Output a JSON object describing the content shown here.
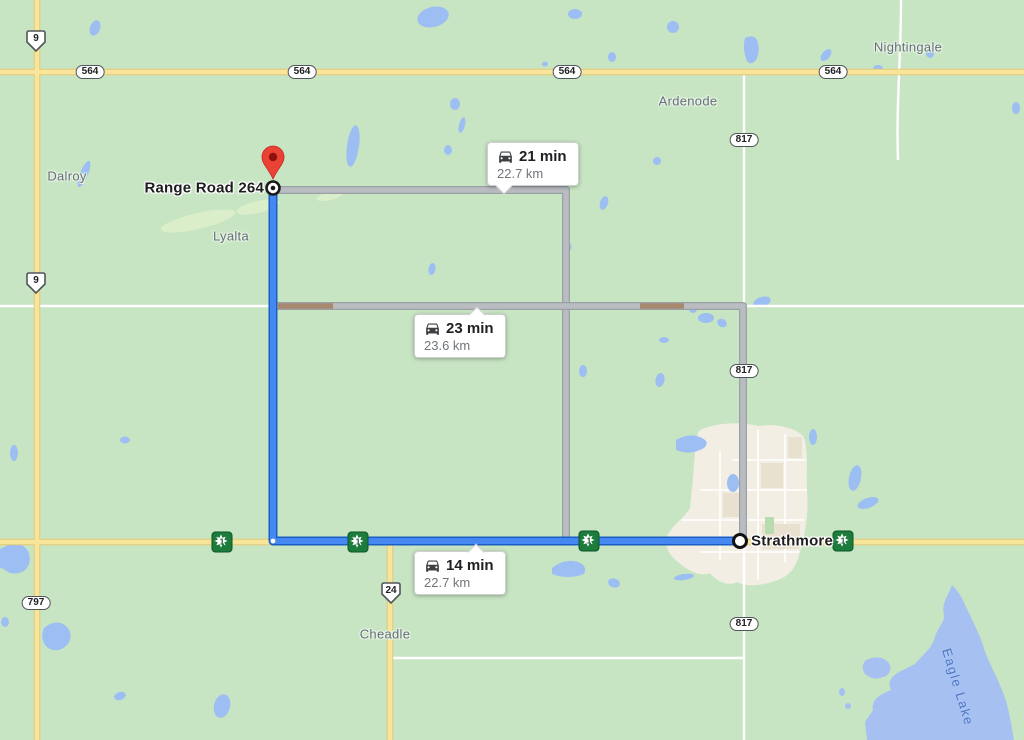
{
  "map_title": "Driving directions from Strathmore to Range Road 264",
  "places": {
    "nightingale": "Nightingale",
    "ardenode": "Ardenode",
    "dalroy": "Dalroy",
    "lyalta": "Lyalta",
    "cheadle": "Cheadle",
    "eagle_lake": "Eagle Lake"
  },
  "markers": {
    "destination_label": "Range Road 264",
    "origin_label": "Strathmore"
  },
  "routes": {
    "alt_north": {
      "duration": "21 min",
      "distance": "22.7 km",
      "selected": false
    },
    "alt_middle": {
      "duration": "23 min",
      "distance": "23.6 km",
      "selected": false
    },
    "main_south": {
      "duration": "14 min",
      "distance": "22.7 km",
      "selected": true
    }
  },
  "shields": {
    "hwy9": "9",
    "hwy24": "24",
    "hwy564": "564",
    "hwy797": "797",
    "hwy817": "817",
    "transcanada": "1"
  },
  "colors": {
    "land": "#c7e5c3",
    "water": "#9dbef2",
    "water_label": "#4e76c4",
    "highway_yellow": "#f7e59b",
    "route_selected": "#4688f1",
    "route_selected_casing": "#1a5ec4",
    "route_alternate": "#b9bcc1",
    "route_traffic": "#a6886e",
    "urban_area": "#f2eee3",
    "pin_red": "#ea4335",
    "transcanada_green": "#1c7c3c"
  }
}
